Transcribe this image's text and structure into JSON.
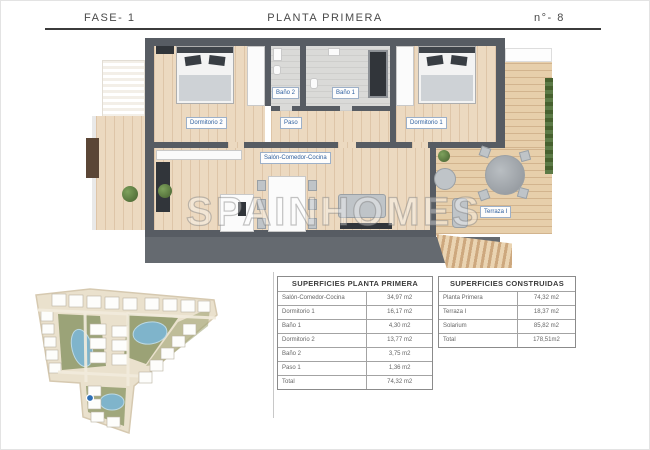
{
  "header": {
    "phase": "FASE- 1",
    "title": "PLANTA PRIMERA",
    "number": "n°- 8"
  },
  "floorplan": {
    "watermark": "SPAINHOMES",
    "labels": {
      "dormitorio_2": "Dormitorio 2",
      "bano_2": "Baño 2",
      "bano_1": "Baño 1",
      "dormitorio_1": "Dormitorio 1",
      "paso": "Paso",
      "salon": "Salón-Comedor-Cocina",
      "terraza": "Terraza I"
    }
  },
  "tables": {
    "planta_primera": {
      "title": "SUPERFICIES PLANTA PRIMERA",
      "rows": [
        {
          "label": "Salón-Comedor-Cocina",
          "value": "34,97 m2"
        },
        {
          "label": "Dormitorio 1",
          "value": "16,17 m2"
        },
        {
          "label": "Baño 1",
          "value": "4,30 m2"
        },
        {
          "label": "Dormitorio 2",
          "value": "13,77 m2"
        },
        {
          "label": "Baño 2",
          "value": "3,75 m2"
        },
        {
          "label": "Paso 1",
          "value": "1,36 m2"
        },
        {
          "label": "Total",
          "value": "74,32 m2"
        }
      ]
    },
    "construidas": {
      "title": "SUPERFICIES CONSTRUIDAS",
      "rows": [
        {
          "label": "Planta Primera",
          "value": "74,32 m2"
        },
        {
          "label": "Terraza I",
          "value": "18,37 m2"
        },
        {
          "label": "Solarium",
          "value": "85,82 m2"
        },
        {
          "label": "Total",
          "value": "178,51m2"
        }
      ]
    }
  },
  "colors": {
    "wall": "#575c63",
    "wood_floor": "#ecd9c0",
    "terrace_deck": "#e7cfab",
    "room_label_text": "#2d5f9f",
    "pool": "#7fb4cb",
    "site_green": "#8d9868",
    "marker": "#2e6fb5"
  }
}
